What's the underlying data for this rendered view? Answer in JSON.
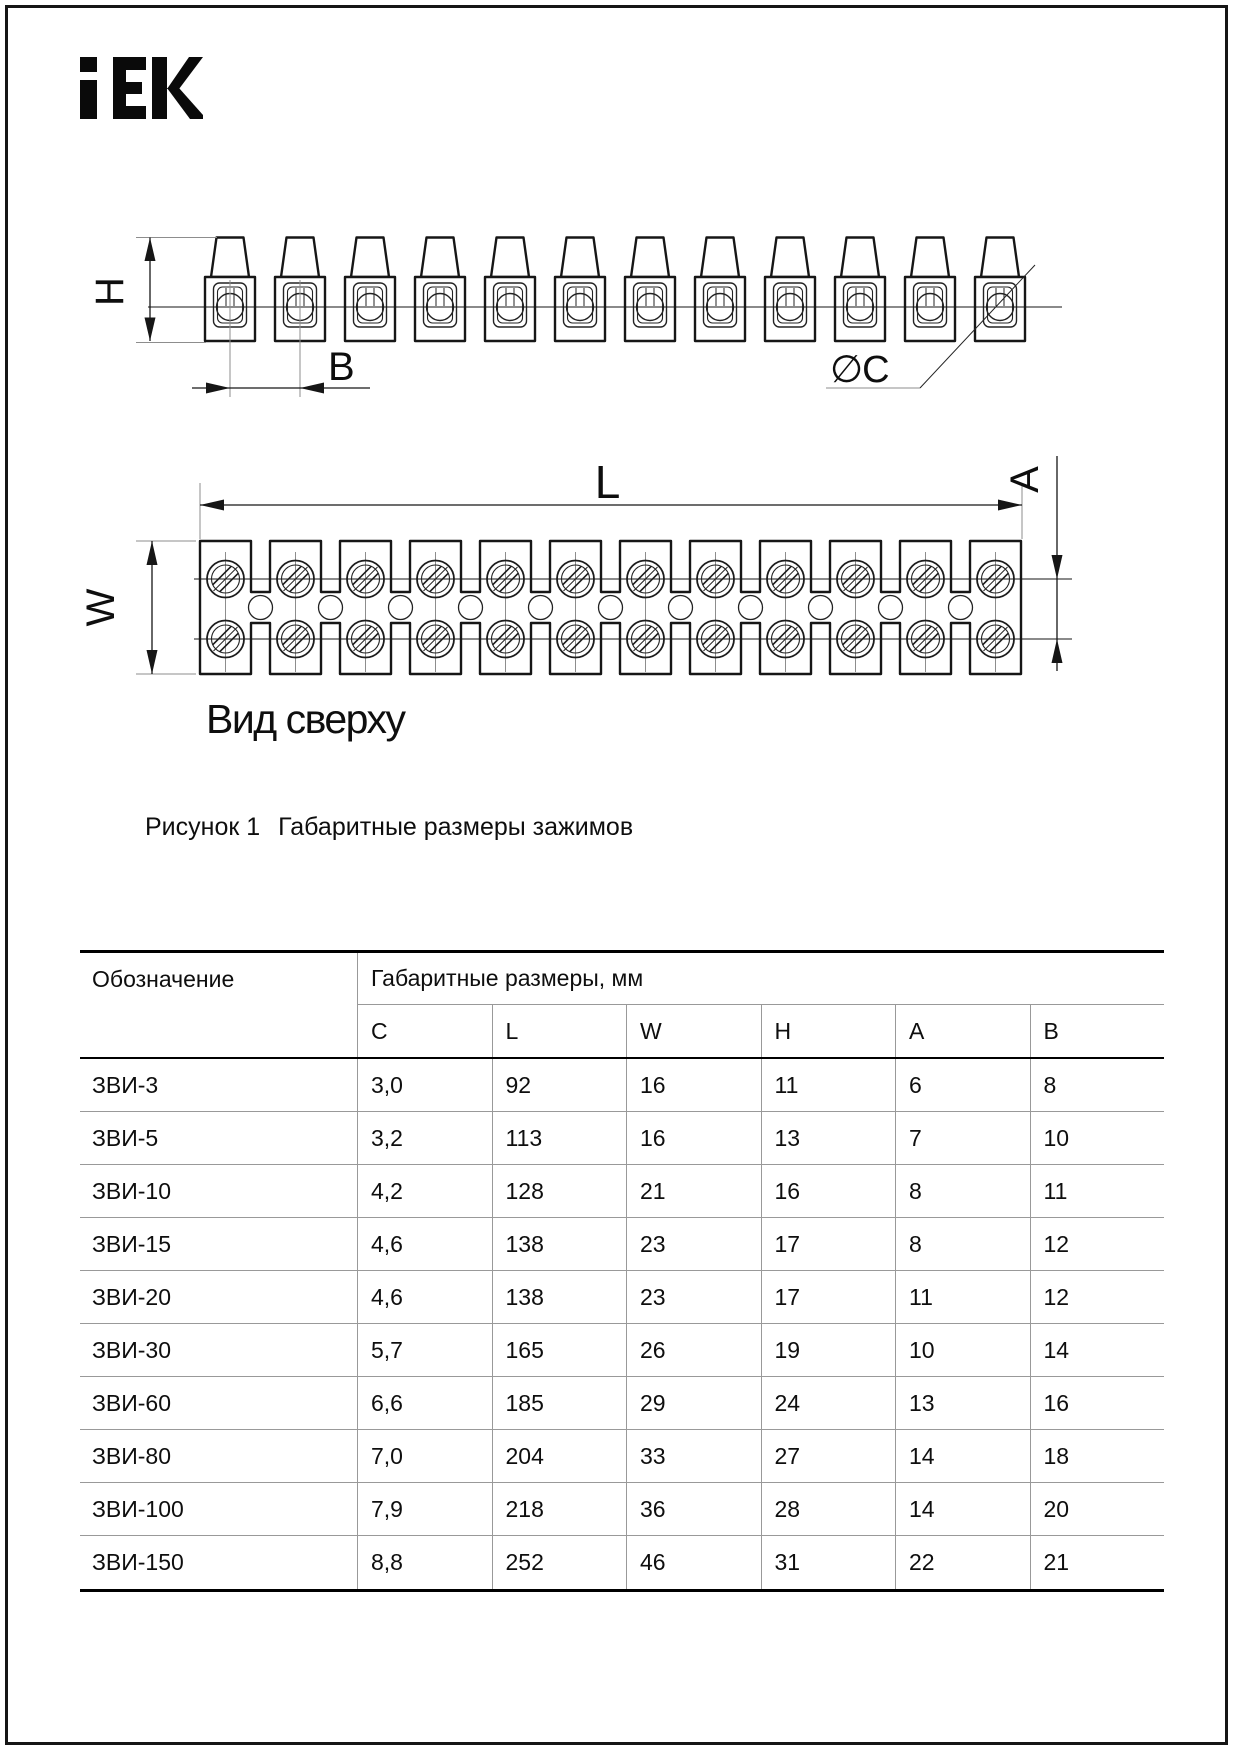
{
  "logo": {
    "text": "iEK"
  },
  "figure": {
    "side_view": {
      "cells": 12,
      "h_label": "H",
      "b_label": "B",
      "c_label": "∅C"
    },
    "top_view": {
      "cells": 12,
      "l_label": "L",
      "w_label": "W",
      "a_label": "A",
      "view_caption": "Вид сверху"
    },
    "caption_label": "Рисунок 1",
    "caption_text": "Габаритные размеры зажимов"
  },
  "table": {
    "col1_header": "Обозначение",
    "group_header": "Габаритные размеры, мм",
    "columns": [
      "C",
      "L",
      "W",
      "H",
      "A",
      "B"
    ],
    "rows": [
      {
        "name": "ЗВИ-3",
        "values": [
          "3,0",
          "92",
          "16",
          "11",
          "6",
          "8"
        ]
      },
      {
        "name": "ЗВИ-5",
        "values": [
          "3,2",
          "113",
          "16",
          "13",
          "7",
          "10"
        ]
      },
      {
        "name": "ЗВИ-10",
        "values": [
          "4,2",
          "128",
          "21",
          "16",
          "8",
          "11"
        ]
      },
      {
        "name": "ЗВИ-15",
        "values": [
          "4,6",
          "138",
          "23",
          "17",
          "8",
          "12"
        ]
      },
      {
        "name": "ЗВИ-20",
        "values": [
          "4,6",
          "138",
          "23",
          "17",
          "11",
          "12"
        ]
      },
      {
        "name": "ЗВИ-30",
        "values": [
          "5,7",
          "165",
          "26",
          "19",
          "10",
          "14"
        ]
      },
      {
        "name": "ЗВИ-60",
        "values": [
          "6,6",
          "185",
          "29",
          "24",
          "13",
          "16"
        ]
      },
      {
        "name": "ЗВИ-80",
        "values": [
          "7,0",
          "204",
          "33",
          "27",
          "14",
          "18"
        ]
      },
      {
        "name": "ЗВИ-100",
        "values": [
          "7,9",
          "218",
          "36",
          "28",
          "14",
          "20"
        ]
      },
      {
        "name": "ЗВИ-150",
        "values": [
          "8,8",
          "252",
          "46",
          "31",
          "22",
          "21"
        ]
      }
    ]
  }
}
